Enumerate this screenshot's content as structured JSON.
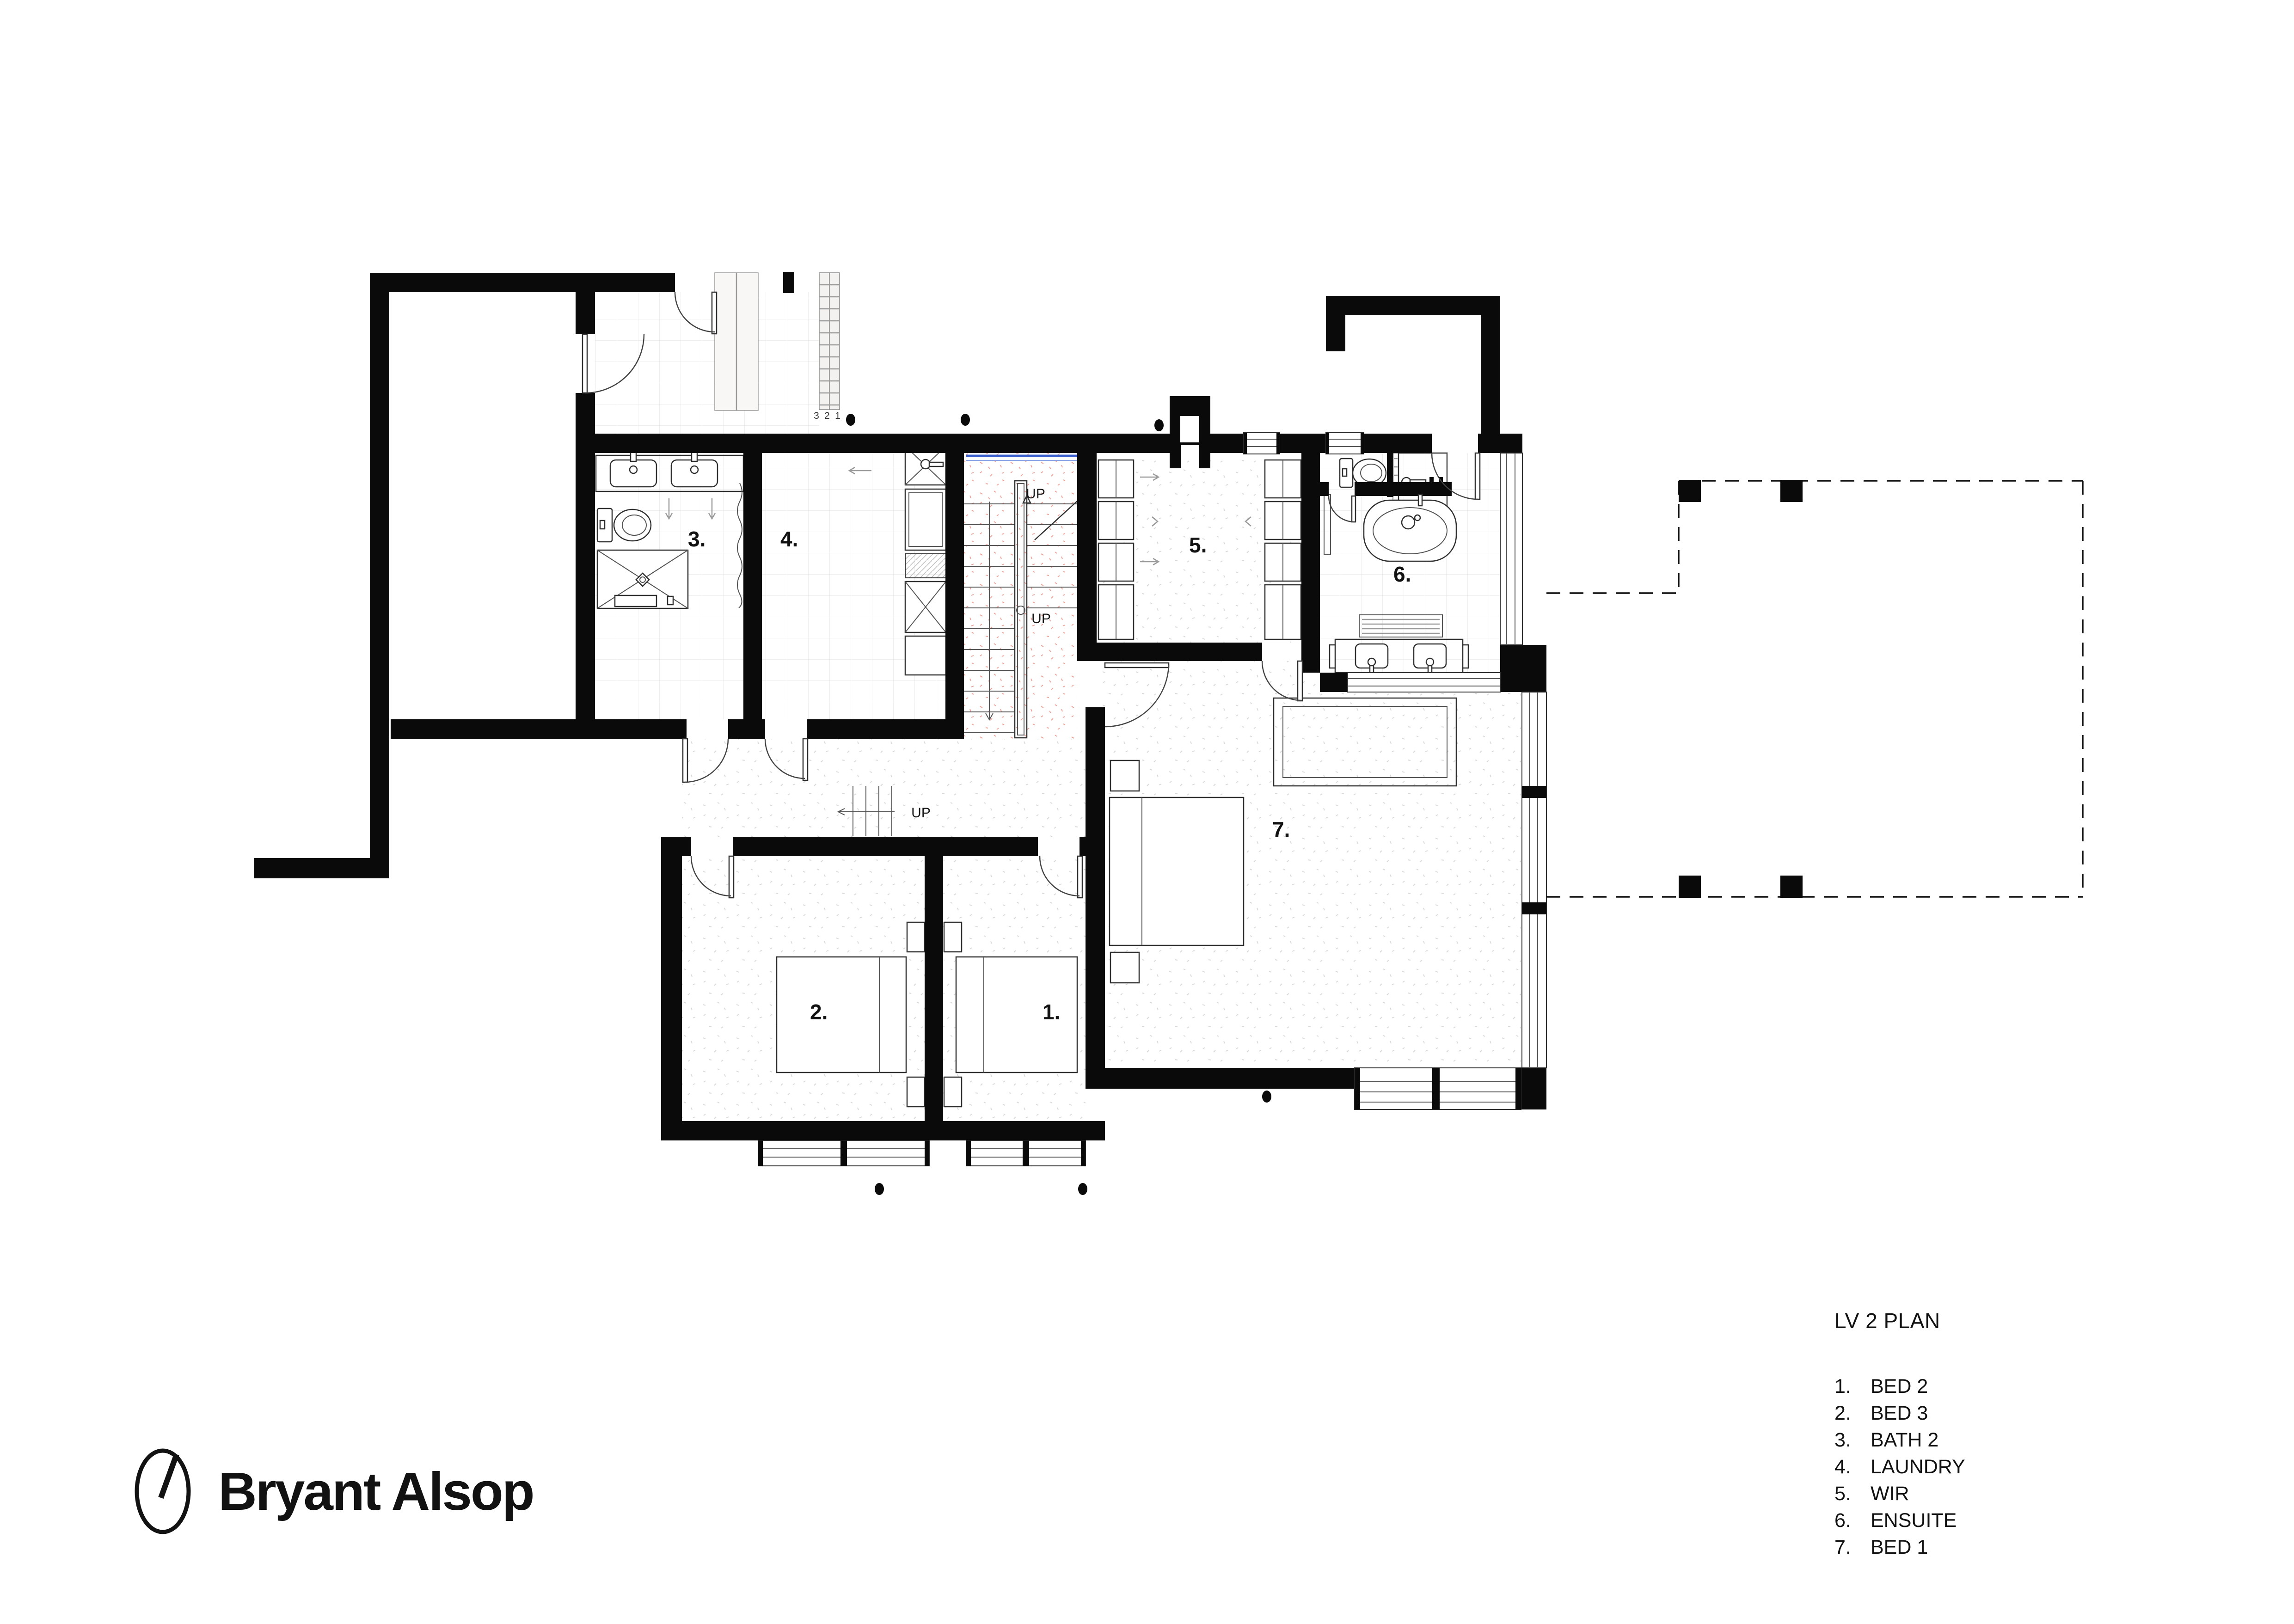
{
  "page": {
    "background": "#ffffff"
  },
  "brand": {
    "name": "Bryant Alsop",
    "icon": "clock-dial-icon"
  },
  "legend": {
    "title": "LV 2 PLAN"
  },
  "rooms": [
    {
      "num": "1.",
      "name": "BED 2"
    },
    {
      "num": "2.",
      "name": "BED 3"
    },
    {
      "num": "3.",
      "name": "BATH 2"
    },
    {
      "num": "4.",
      "name": "LAUNDRY"
    },
    {
      "num": "5.",
      "name": "WIR"
    },
    {
      "num": "6.",
      "name": "ENSUITE"
    },
    {
      "num": "7.",
      "name": "BED 1"
    }
  ],
  "annotations": {
    "up_label": "UP",
    "tread_numbers": [
      "3",
      "2",
      "1"
    ]
  },
  "colors": {
    "wall": "#0a0a0a",
    "drawing_line": "#2f2f2f",
    "glazing_accent": "#3a5fcd",
    "stair_floor_tint": "#e59a90",
    "tile_line": "#e8e8e8",
    "floor_speckle": "#d8d8d8"
  }
}
